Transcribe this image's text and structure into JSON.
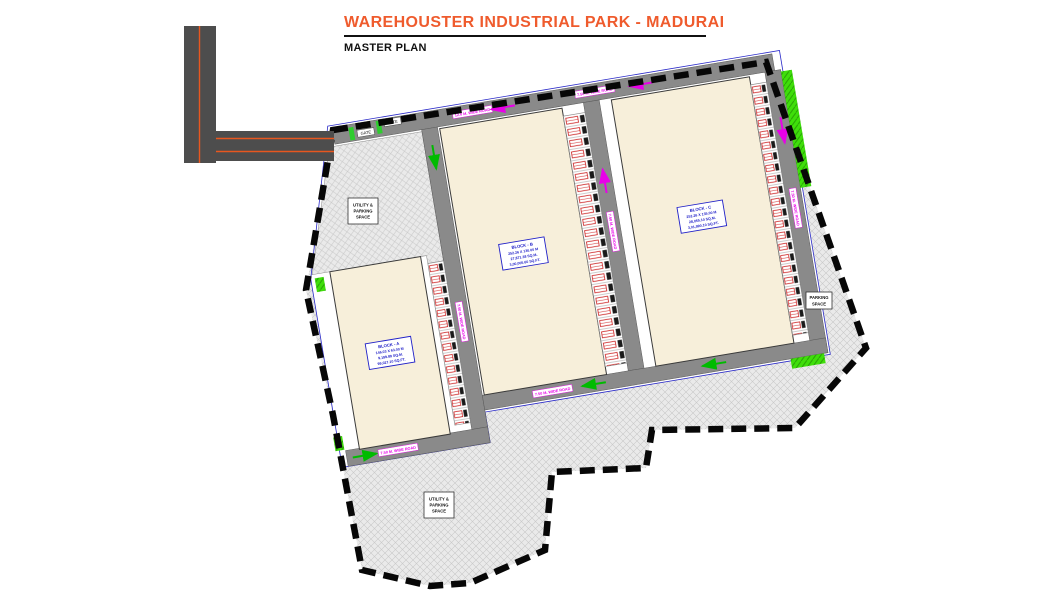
{
  "header": {
    "title": "WAREHOUSTER INDUSTRIAL PARK - MADURAI",
    "subtitle": "MASTER PLAN"
  },
  "plan": {
    "blocks": [
      {
        "label": "BLOCK - A",
        "line2": "146.03 X 63.00 M",
        "line3": "9,199.89 SQ.M.",
        "line4": "99,027.10 SQ.FT."
      },
      {
        "label": "BLOCK - B",
        "line2": "252.26 X 130.00 M",
        "line3": "27,871.38 SQ.M.",
        "line4": "3,00,005.60 SQ.FT."
      },
      {
        "label": "BLOCK - C",
        "line2": "252.26 X 135.00 M",
        "line3": "28,055.10 SQ.M.",
        "line4": "3,01,990.10 SQ.FT."
      }
    ],
    "road_labels": {
      "main": "12.0 M. WIDE ROAD",
      "internal": "7.50 M. WIDE ROAD"
    },
    "areas": {
      "northwest": {
        "l1": "UTILITY &",
        "l2": "PARKING",
        "l3": "SPACE"
      },
      "east": {
        "l1": "PARKING",
        "l2": "SPACE"
      },
      "south": {
        "l1": "UTILITY &",
        "l2": "PARKING",
        "l3": "SPACE"
      }
    },
    "gate": "GATE",
    "colors": {
      "title_orange": "#EF5B2D",
      "road_gray": "#8A8A8A",
      "block_cream": "#F7EFDA",
      "green": "#3FDF0A",
      "label_blue": "#2020C8",
      "road_label_magenta": "#E800E8",
      "dock_red": "#CC2222"
    }
  }
}
